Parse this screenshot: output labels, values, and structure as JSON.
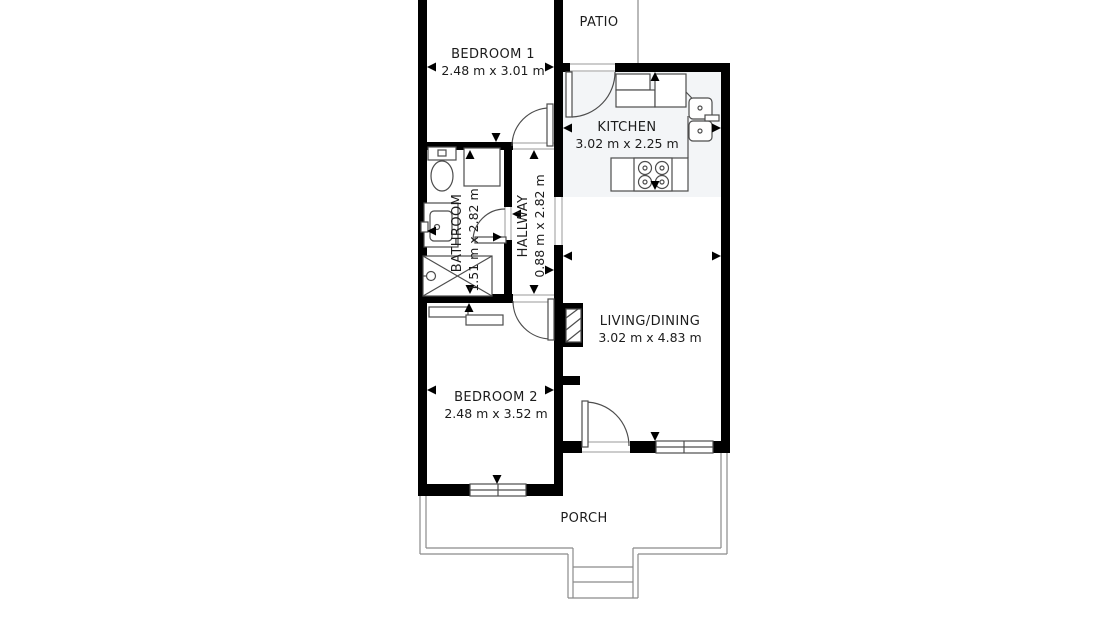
{
  "floorplan": {
    "rooms": {
      "bedroom1": {
        "name": "BEDROOM 1",
        "dims": "2.48 m x 3.01 m"
      },
      "patio": {
        "name": "PATIO"
      },
      "kitchen": {
        "name": "KITCHEN",
        "dims": "3.02 m x 2.25 m"
      },
      "bathroom": {
        "name": "BATHROOM",
        "dims": "1.51 m x 2.82 m"
      },
      "hallway": {
        "name": "HALLWAY",
        "dims": "0.88 m x 2.82 m"
      },
      "living": {
        "name": "LIVING/DINING",
        "dims": "3.02 m x 4.83 m"
      },
      "bedroom2": {
        "name": "BEDROOM 2",
        "dims": "2.48 m x 3.52 m"
      },
      "porch": {
        "name": "PORCH"
      }
    },
    "colors": {
      "wall": "#000000",
      "fixture_line": "#4d4d4d",
      "porch_outline": "#8a8a8a",
      "kitchen_floor": "#f3f5f7",
      "text": "#1c1c1c",
      "background": "#ffffff"
    }
  }
}
